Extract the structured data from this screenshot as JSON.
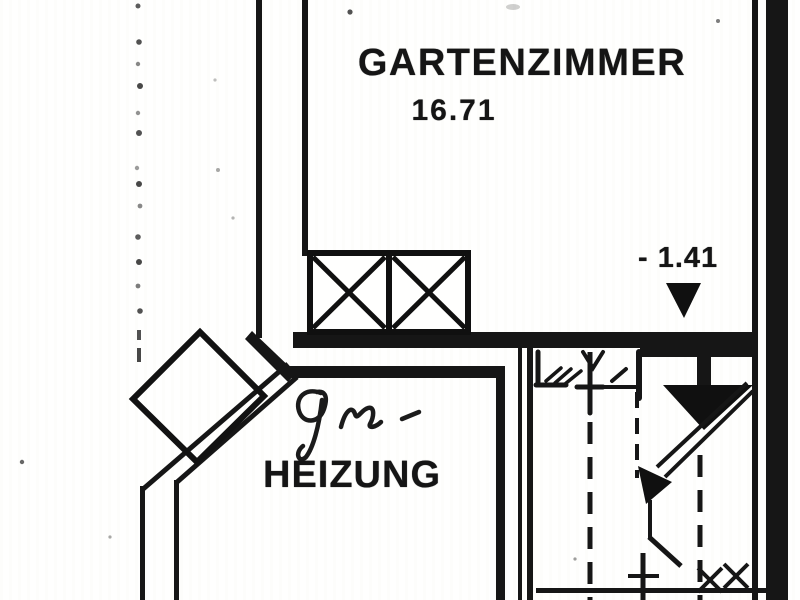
{
  "floor_plan": {
    "rooms": [
      {
        "id": "gartenzimmer",
        "name": "GARTENZIMMER",
        "area": "16.71"
      },
      {
        "id": "heizung",
        "name": "HEIZUNG",
        "handwritten_annotation": "Gas-"
      }
    ],
    "elevation_marker": {
      "value": "- 1.41",
      "symbol": "filled-down-triangle"
    },
    "symbols": [
      "shaft-crossed-box",
      "double-door",
      "stair-direction-arrow",
      "chimney-block",
      "elevation-marker"
    ],
    "colors": {
      "ink": "#1a1a1a",
      "paper": "#fbfbf9"
    }
  }
}
